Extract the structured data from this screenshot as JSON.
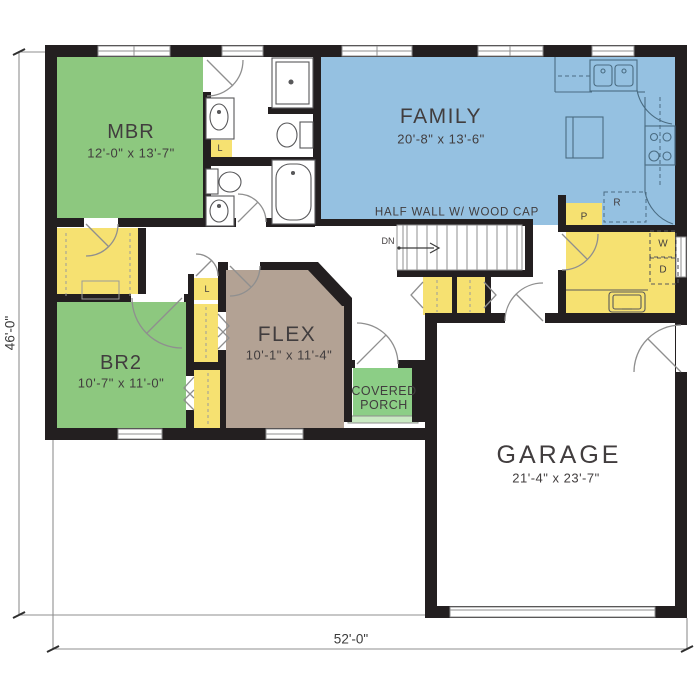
{
  "plan": {
    "rooms": {
      "mbr": {
        "label": "MBR",
        "dims": "12'-0\" x 13'-7\""
      },
      "family": {
        "label": "FAMILY",
        "dims": "20'-8\" x 13'-6\""
      },
      "br2": {
        "label": "BR2",
        "dims": "10'-7\" x 11'-0\""
      },
      "flex": {
        "label": "FLEX",
        "dims": "10'-1\" x 11'-4\""
      },
      "garage": {
        "label": "GARAGE",
        "dims": "21'-4\" x 23'-7\""
      },
      "porch": {
        "label": "COVERED PORCH"
      }
    },
    "annotations": {
      "half_wall": "HALF WALL W/ WOOD CAP",
      "stairs_down": "DN",
      "pantry": "P",
      "refrigerator": "R",
      "washer": "W",
      "dryer": "D",
      "linen_master_bath": "L",
      "linen_hall": "L"
    },
    "dimensions": {
      "overall_depth": "46'-0\"",
      "overall_width": "52'-0\""
    },
    "colors": {
      "walls": "#231f20",
      "bedroom_green": "#8dc87f",
      "family_blue": "#95c1e1",
      "closet_yellow": "#f6e171",
      "flex_brown": "#b3a294",
      "porch_green": "#8cce86",
      "fixture_grey": "#58585a"
    }
  }
}
